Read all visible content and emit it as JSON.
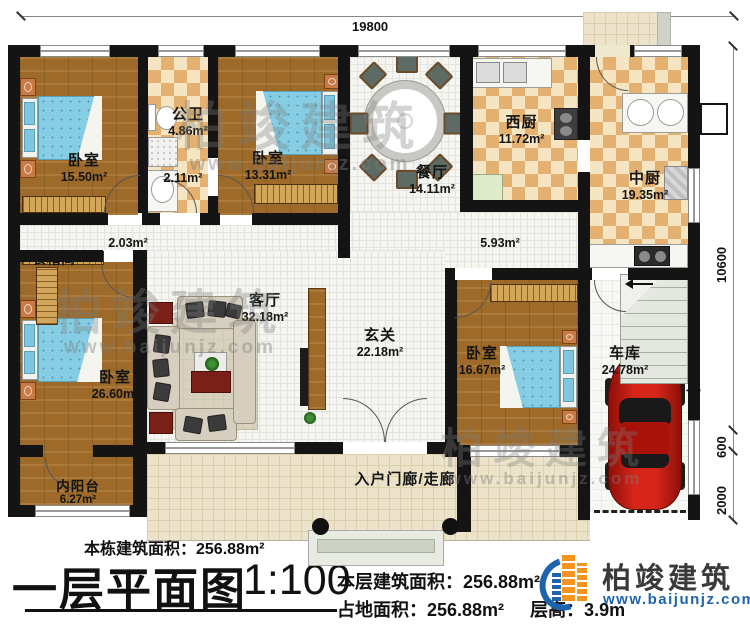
{
  "dimensions": {
    "top": "19800",
    "right_main": "10600",
    "right_mid": "600",
    "right_front": "2000"
  },
  "rooms": {
    "bedroom1": {
      "name": "卧室",
      "area": "15.50m²"
    },
    "bathroom": {
      "name": "公卫",
      "area": "4.86m²"
    },
    "wash": {
      "area": "2.11m²"
    },
    "bedroom2": {
      "name": "卧室",
      "area": "13.31m²"
    },
    "dining": {
      "name": "餐厅",
      "area": "14.11m²"
    },
    "west_kitchen": {
      "name": "西厨",
      "area": "11.72m²"
    },
    "mid_kitchen": {
      "name": "中厨",
      "area": "19.35m²"
    },
    "corridor_left": {
      "area": "2.03m²"
    },
    "corridor_right": {
      "area": "5.93m²"
    },
    "cloakroom": {
      "name": "衣帽间"
    },
    "bedroom3": {
      "name": "卧室",
      "area": "26.60m²"
    },
    "living": {
      "name": "客厅",
      "area": "32.18m²"
    },
    "foyer": {
      "name": "玄关",
      "area": "22.18m²"
    },
    "bedroom4": {
      "name": "卧室",
      "area": "16.67m²"
    },
    "garage": {
      "name": "车库",
      "area": "24.78m²"
    },
    "balcony": {
      "name": "内阳台",
      "area": "6.27m²"
    },
    "porch": {
      "name": "入户门廊/走廊"
    }
  },
  "stairs": {
    "up_label": "上"
  },
  "footer": {
    "total_building_area": "本栋建筑面积：256.88m²",
    "title": "一层平面图",
    "scale": "1:100",
    "floor_area": "本层建筑面积：256.88m²",
    "land_area": "占地面积：256.88m²",
    "floor_height": "层高：3.9m"
  },
  "logo": {
    "name": "柏竣建筑",
    "url": "www.baijunjz.com"
  },
  "watermark": {
    "text": "柏竣建筑",
    "url": "www.baijunjz.com"
  },
  "colors": {
    "accent_blue": "#1d63ad",
    "accent_orange": "#f6921e",
    "wall": "#141414",
    "wood": "#a5702c",
    "checker_dark": "#e4b170",
    "bed_blue": "#86cde4",
    "car_red": "#c41b10"
  }
}
